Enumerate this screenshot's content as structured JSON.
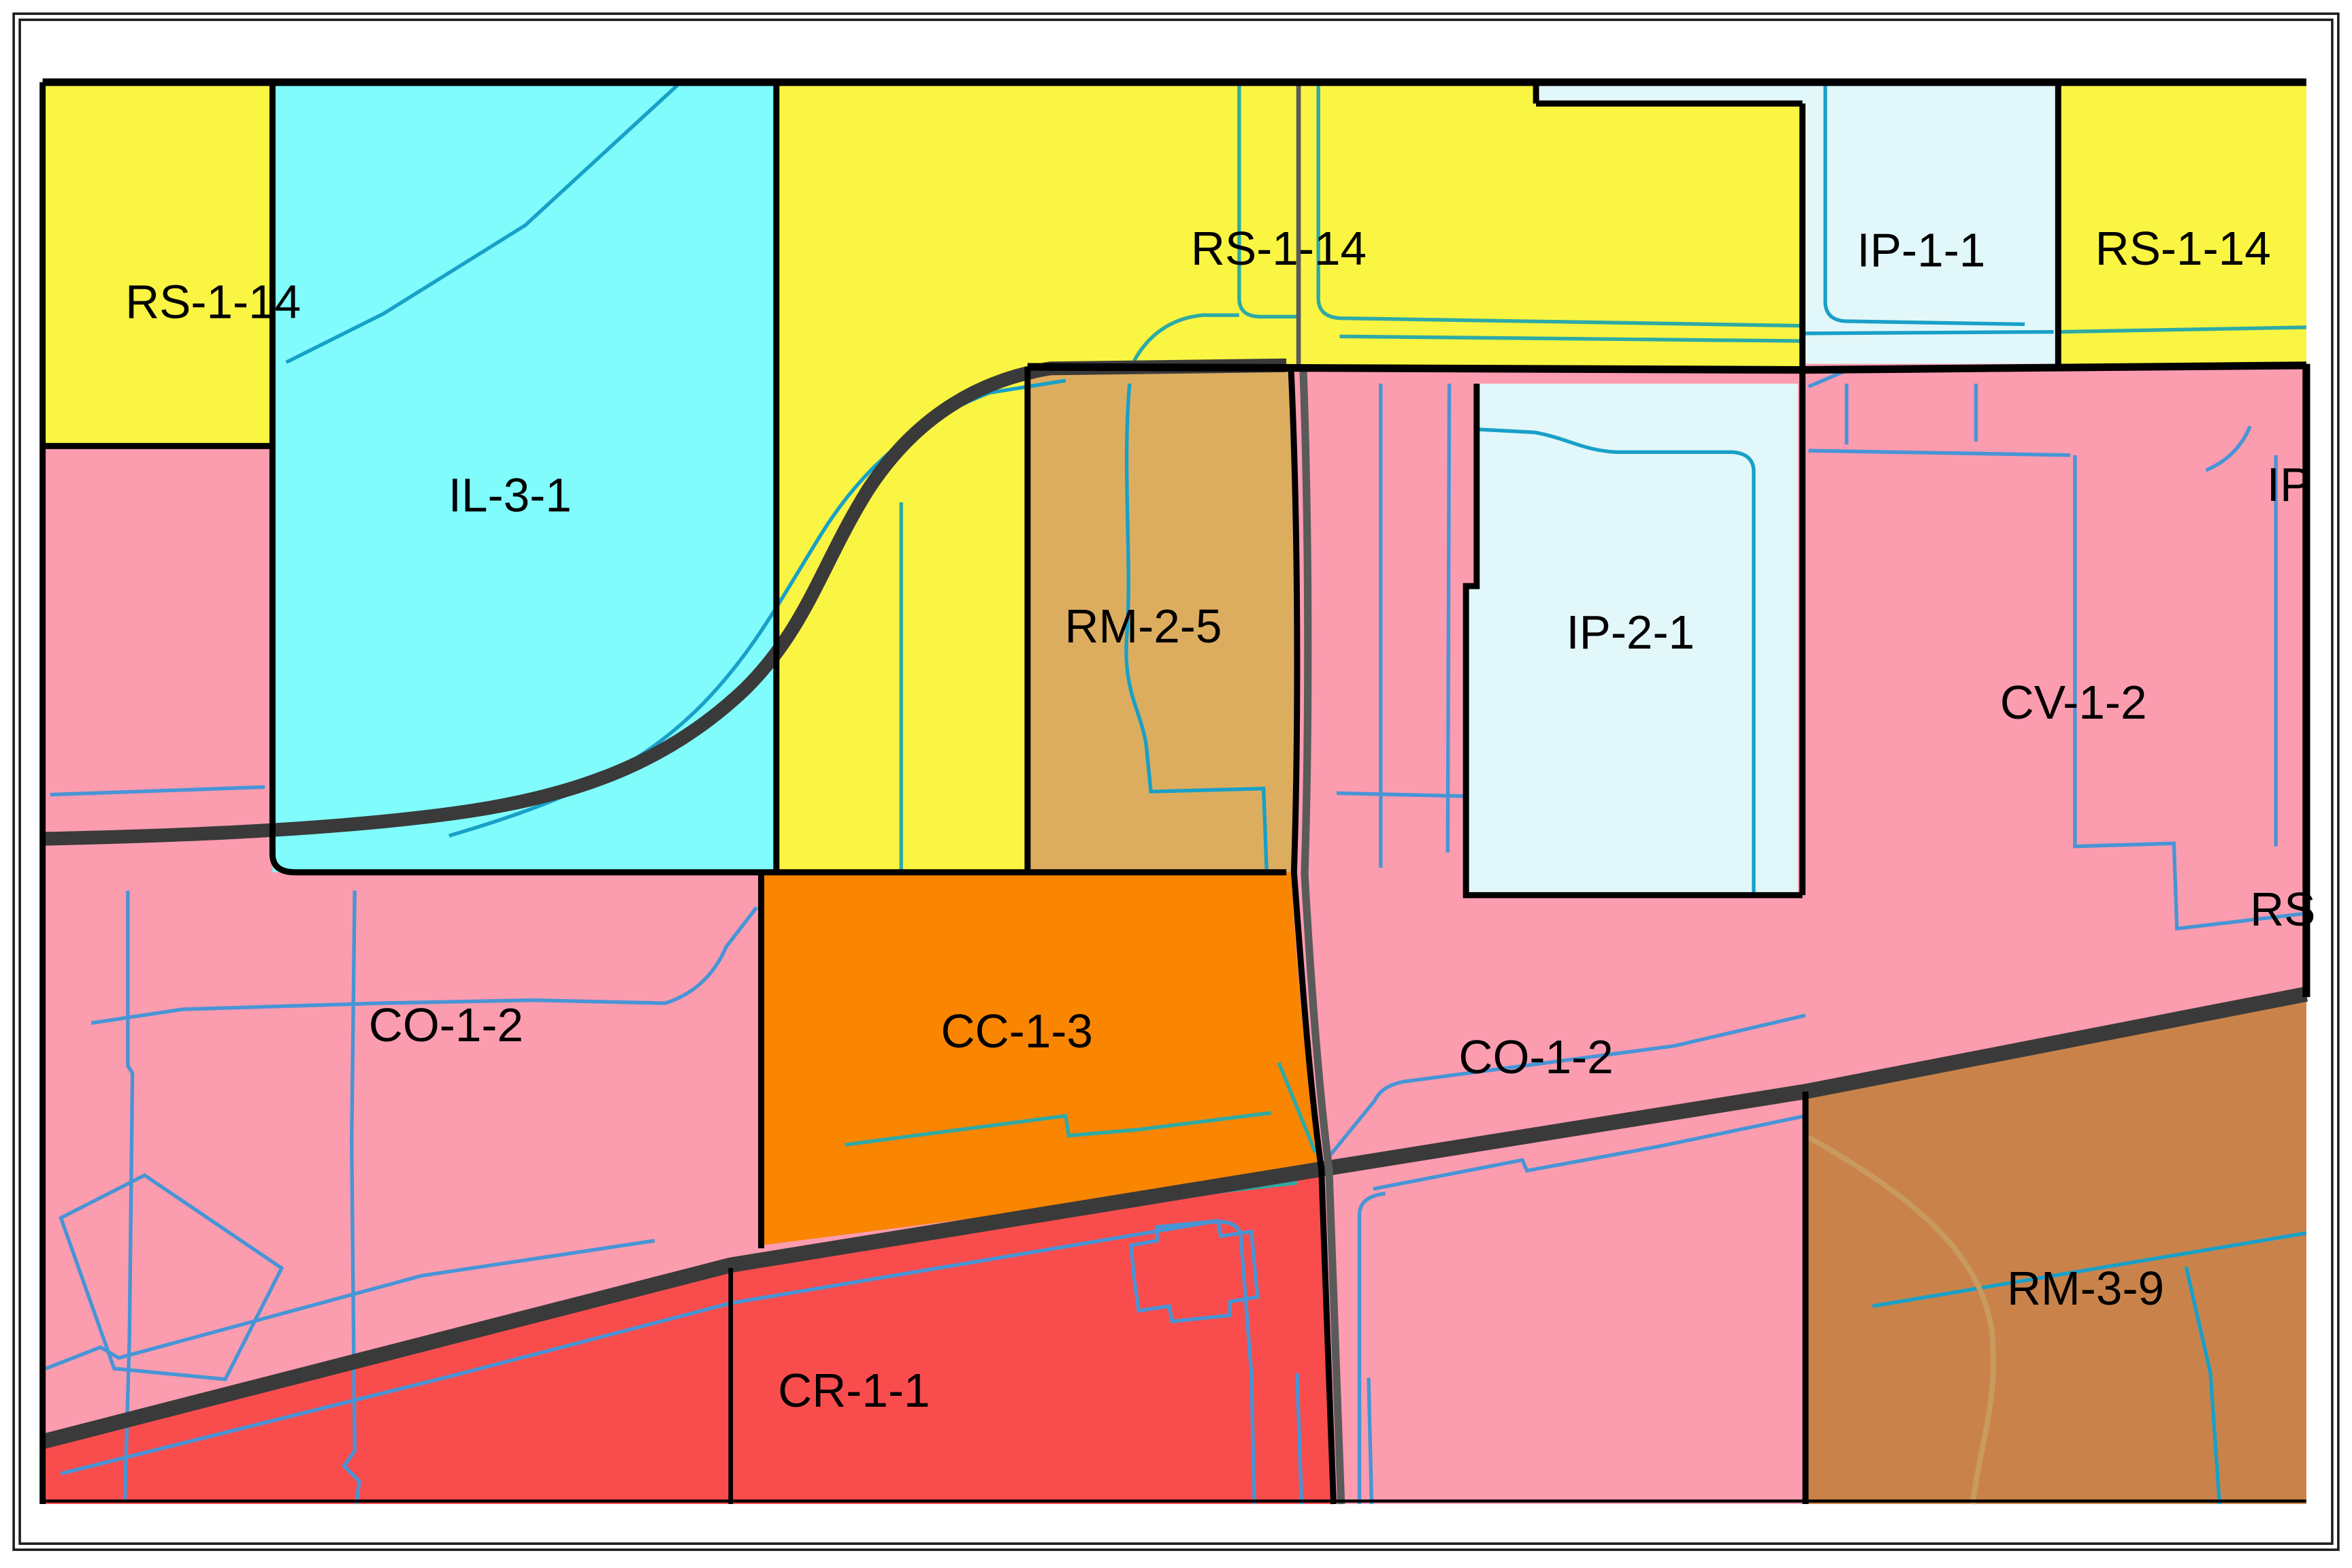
{
  "map": {
    "type": "zoning-map",
    "background": "#ffffff",
    "zones": [
      {
        "id": "pink-base",
        "label": "",
        "color": "#FC9CAF"
      },
      {
        "id": "rs-1-14-nw",
        "label": "RS-1-14",
        "color": "#FAF542"
      },
      {
        "id": "il-3-1",
        "label": "IL-3-1",
        "color": "#80FCFC"
      },
      {
        "id": "rs-1-14-n",
        "label": "RS-1-14",
        "color": "#FAF542"
      },
      {
        "id": "ip-1-1",
        "label": "IP-1-1",
        "color": "#E2F7F9"
      },
      {
        "id": "rs-1-14-ne",
        "label": "RS-1-14",
        "color": "#FAF542"
      },
      {
        "id": "rm-2-5",
        "label": "RM-2-5",
        "color": "#DDAD5F"
      },
      {
        "id": "ip-2-1",
        "label": "IP-2-1",
        "color": "#E2F7F9"
      },
      {
        "id": "cv-1-2",
        "label": "CV-1-2",
        "color": "#FC9CAF"
      },
      {
        "id": "co-1-2-w",
        "label": "CO-1-2",
        "color": "#FC9CAF"
      },
      {
        "id": "cc-1-3",
        "label": "CC-1-3",
        "color": "#F98500"
      },
      {
        "id": "co-1-2-e",
        "label": "CO-1-2",
        "color": "#FC9CAF"
      },
      {
        "id": "rm-3-9",
        "label": "RM-3-9",
        "color": "#C9834A"
      },
      {
        "id": "cr-1-1",
        "label": "CR-1-1",
        "color": "#F94D4D"
      }
    ],
    "partial_labels": [
      {
        "id": "ip-edge",
        "label": "IP"
      },
      {
        "id": "rs-edge",
        "label": "RS"
      }
    ],
    "line_colors": {
      "zone_boundary": "#000000",
      "major_road": "#3a3a3a",
      "minor_road_gray": "#5a5a5a",
      "minor_road_tan": "#c99a5f",
      "parcel_blue": "#4795d6",
      "parcel_teal": "#2eaaa6",
      "parcel_cyan": "#18a0c8",
      "frame": "#1c1c1c"
    }
  }
}
